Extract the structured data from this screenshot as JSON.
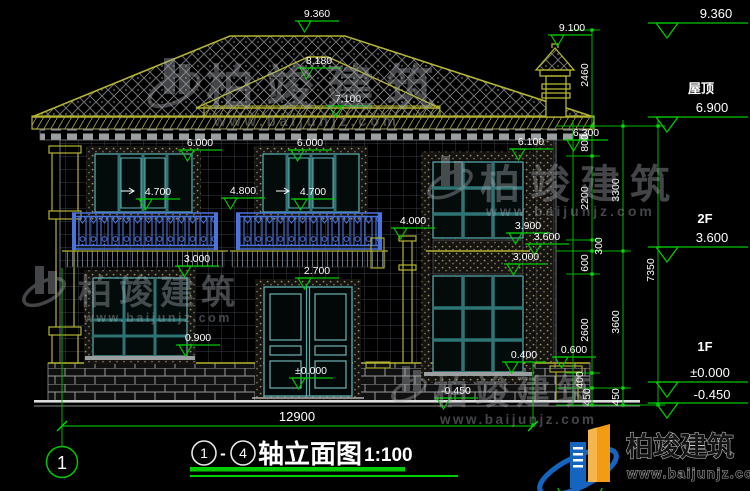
{
  "drawing": {
    "overall_dim": "12900",
    "axis_bubble": "1"
  },
  "title_block": {
    "axis_from": "1",
    "axis_to": "4",
    "separator": "-",
    "title": "轴立面图",
    "scale": "1:100"
  },
  "levels": {
    "top_value": "9.360",
    "roof_label": "屋顶",
    "roof_value": "6.900",
    "f2_label": "2F",
    "f2_value": "3.600",
    "f1_label": "1F",
    "f1_value": "±0.000",
    "below_value": "-0.450"
  },
  "marks": [
    "9.360",
    "8.180",
    "7.100",
    "6.000",
    "6.000",
    "4.700",
    "4.800",
    "4.700",
    "9.100",
    "6.300",
    "6.100",
    "4.000",
    "3.900",
    "3.600",
    "3.000",
    "3.000",
    "2.700",
    "0.900",
    "0.400",
    "0.600",
    "±0.000",
    "-0.450"
  ],
  "vdims": [
    "2460",
    "800",
    "2200",
    "3300",
    "300",
    "600",
    "7350",
    "2600",
    "3600",
    "400",
    "450",
    "450"
  ],
  "watermark": {
    "brand": "柏竣建筑",
    "url": "www.baijunjz.com"
  },
  "logo": {
    "brand": "柏竣建筑",
    "url": "www.baijunjz.com"
  },
  "colors": {
    "dim_green": "#00c800",
    "roof_olive": "#b4b432",
    "window_teal": "#3f8f8f",
    "railing_blue": "#4a73dc",
    "brand_blue": "#1565c0",
    "brand_orange": "#f39c12"
  }
}
